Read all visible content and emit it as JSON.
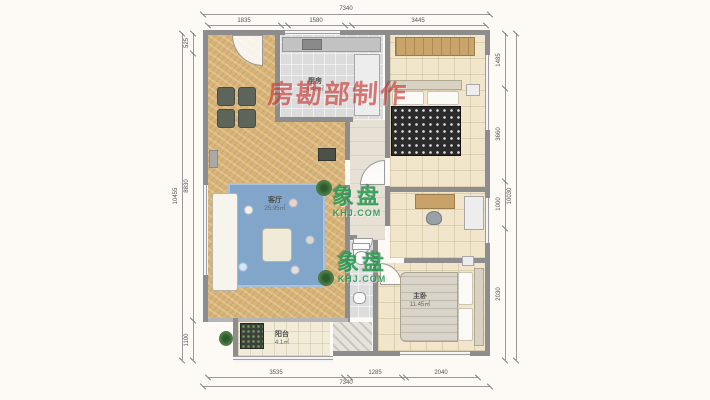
{
  "watermarks": {
    "maker_stamp": "房勘部制作",
    "brand_name": "象盘",
    "brand_site": "KHJ.COM"
  },
  "rooms": {
    "kitchen": {
      "name": "厨房",
      "area": "4.46㎡"
    },
    "living": {
      "name": "客厅",
      "area": "25.95㎡"
    },
    "master": {
      "name": "主卧",
      "area": "11.45㎡"
    },
    "balcony": {
      "name": "阳台",
      "area": "4.1㎡"
    }
  },
  "dimensions": {
    "top": {
      "total": "7340",
      "segments": [
        "1835",
        "1580",
        "3445"
      ]
    },
    "bottom": {
      "total": "7340",
      "segments": [
        "3535",
        "1285",
        "2040"
      ]
    },
    "left": {
      "total": "10455",
      "segments": [
        "525",
        "8830",
        "1100"
      ]
    },
    "right": {
      "total": "10030",
      "segments": [
        "1485",
        "3660",
        "1000",
        "2030"
      ]
    }
  }
}
